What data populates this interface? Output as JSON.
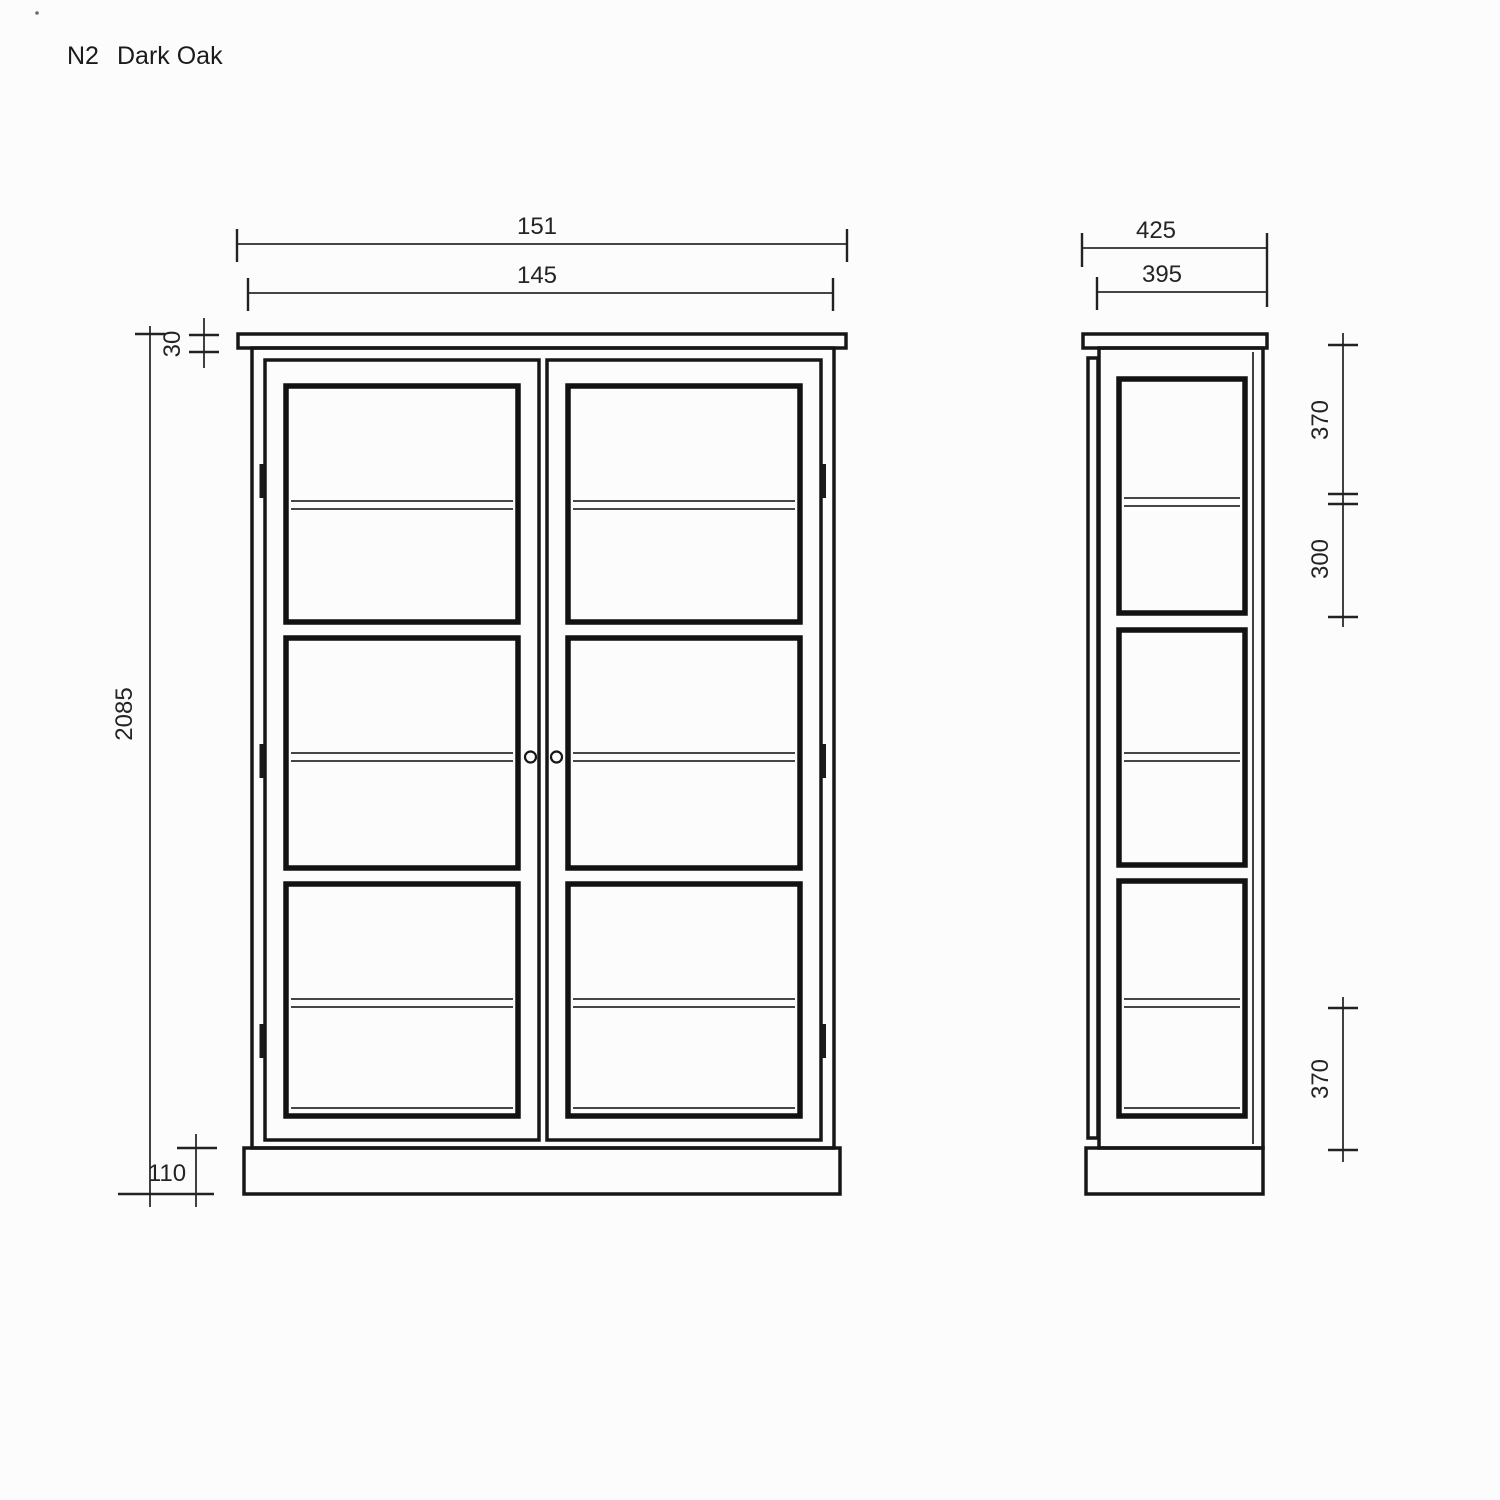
{
  "title": {
    "code": "N2",
    "finish": "Dark Oak"
  },
  "front_view": {
    "description": "front elevation of two-door glazed cabinet",
    "dims": {
      "top_width": "151",
      "carcass_width": "145",
      "top_thickness": "30",
      "total_height": "2085",
      "plinth_height": "110"
    }
  },
  "side_view": {
    "description": "side elevation of cabinet",
    "dims": {
      "top_depth": "425",
      "carcass_depth": "395",
      "upper_glass_height": "370",
      "middle_glass_height": "300",
      "lower_glass_height": "370"
    }
  },
  "colors": {
    "background": "#fcfcfc",
    "outline": "#161616",
    "dimension_line": "#2b2b2b",
    "text": "#242424"
  }
}
